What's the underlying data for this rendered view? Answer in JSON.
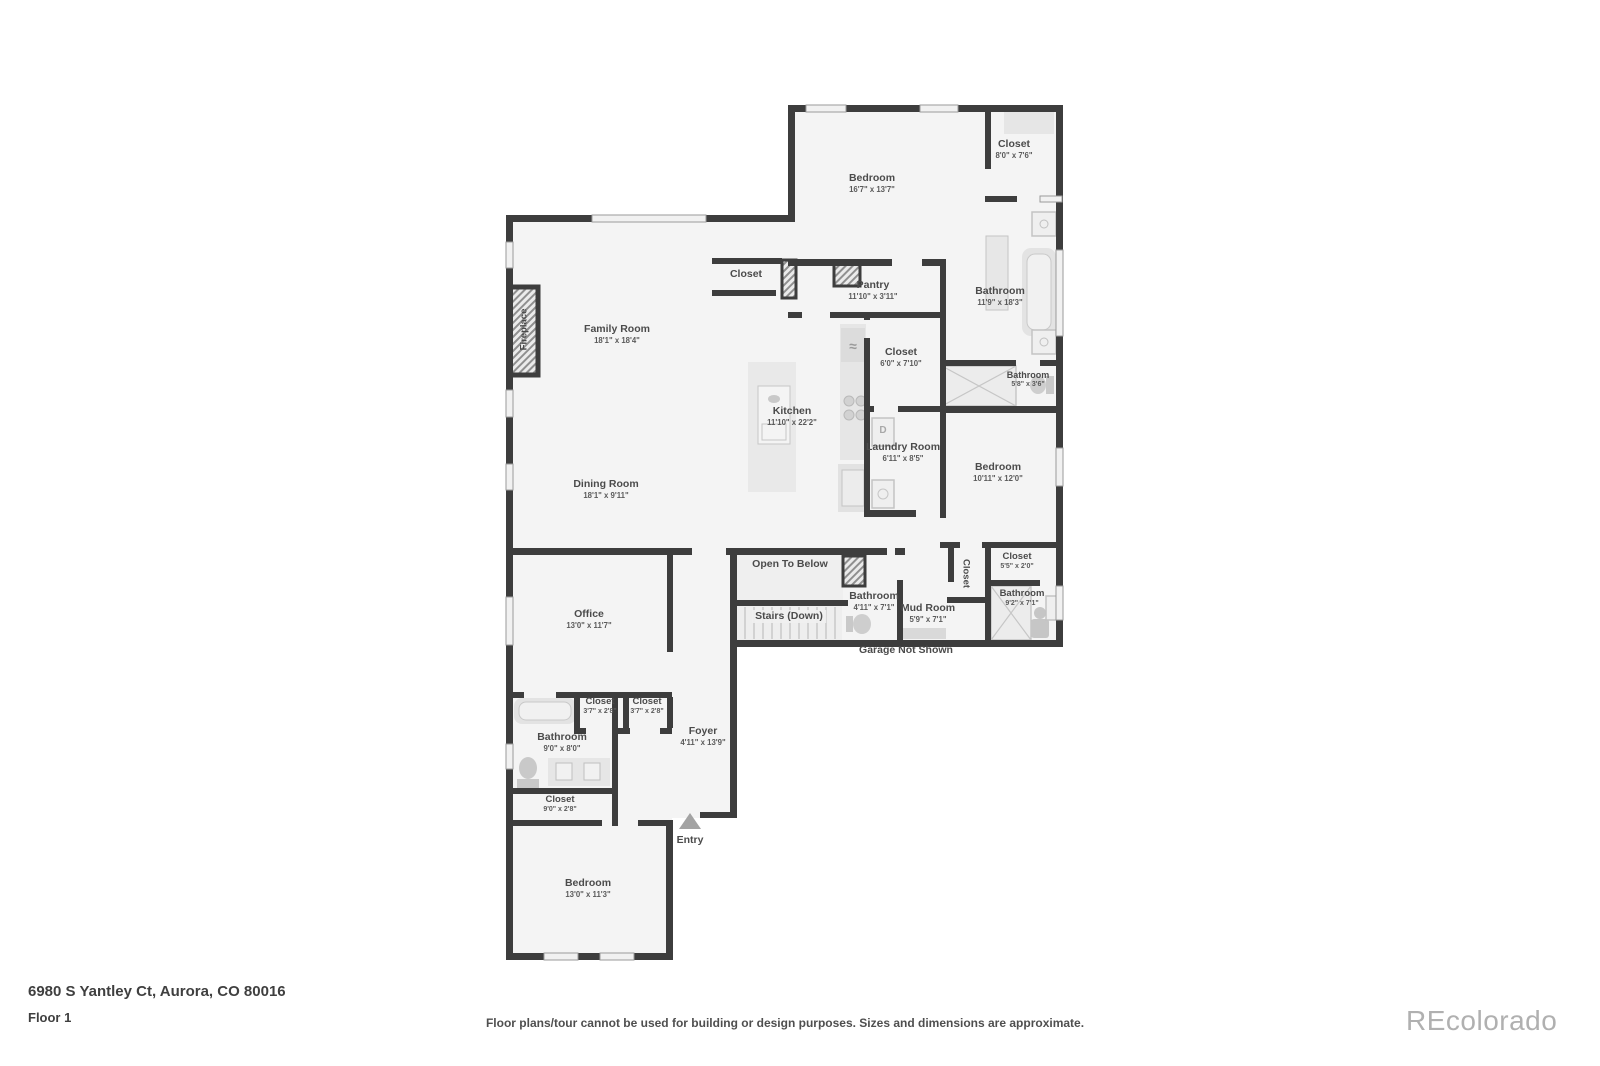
{
  "footer": {
    "address": "6980 S Yantley Ct, Aurora, CO 80016",
    "floor_label": "Floor 1",
    "disclaimer": "Floor plans/tour cannot be used for building or design purposes. Sizes and dimensions are approximate.",
    "watermark": "REcolorado"
  },
  "colors": {
    "wall": "#3d3d3d",
    "floor": "#f4f4f4",
    "label": "#4b4b4b",
    "fixture": "#e6e6e6",
    "watermark": "#b0b0b0"
  },
  "fixtures": {
    "dryer_label": "D",
    "fridge_icon": "≈"
  },
  "rooms": {
    "bedroom_upper": {
      "name": "Bedroom",
      "dims": "16'7\" x 13'7\""
    },
    "closet_upper": {
      "name": "Closet",
      "dims": "8'0\" x 7'6\""
    },
    "family_room": {
      "name": "Family Room",
      "dims": "18'1\" x 18'4\""
    },
    "closet_family": {
      "name": "Closet"
    },
    "pantry": {
      "name": "Pantry",
      "dims": "11'10\" x 3'11\""
    },
    "bathroom_primary": {
      "name": "Bathroom",
      "dims": "11'9\" x 18'3\""
    },
    "closet_mid": {
      "name": "Closet",
      "dims": "6'0\" x 7'10\""
    },
    "bathroom_small": {
      "name": "Bathroom",
      "dims": "5'8\" x 3'6\""
    },
    "kitchen": {
      "name": "Kitchen",
      "dims": "11'10\" x 22'2\""
    },
    "laundry": {
      "name": "Laundry Room",
      "dims": "6'11\" x 8'5\""
    },
    "bedroom_right": {
      "name": "Bedroom",
      "dims": "10'11\" x 12'0\""
    },
    "dining_room": {
      "name": "Dining Room",
      "dims": "18'1\" x 9'11\""
    },
    "fireplace": {
      "name": "Fireplace"
    },
    "open_to_below": {
      "name": "Open To Below"
    },
    "stairs": {
      "name": "Stairs (Down)"
    },
    "bathroom_stairs": {
      "name": "Bathroom",
      "dims": "4'11\" x 7'1\""
    },
    "mud_room": {
      "name": "Mud Room",
      "dims": "5'9\" x 7'1\""
    },
    "closet_mud": {
      "name": "Closet"
    },
    "closet_hall": {
      "name": "Closet",
      "dims": "5'5\" x 2'0\""
    },
    "bathroom_hall": {
      "name": "Bathroom",
      "dims": "9'2\" x 7'1\""
    },
    "garage_note": {
      "name": "Garage Not Shown"
    },
    "office": {
      "name": "Office",
      "dims": "13'0\" x 11'7\""
    },
    "closet_office_1": {
      "name": "Closet",
      "dims": "3'7\" x 2'8\""
    },
    "closet_office_2": {
      "name": "Closet",
      "dims": "3'7\" x 2'8\""
    },
    "bathroom_lower": {
      "name": "Bathroom",
      "dims": "9'0\" x 8'0\""
    },
    "closet_lower": {
      "name": "Closet",
      "dims": "9'0\" x 2'8\""
    },
    "foyer": {
      "name": "Foyer",
      "dims": "4'11\" x 13'9\""
    },
    "entry": {
      "name": "Entry"
    },
    "bedroom_lower": {
      "name": "Bedroom",
      "dims": "13'0\" x 11'3\""
    }
  }
}
